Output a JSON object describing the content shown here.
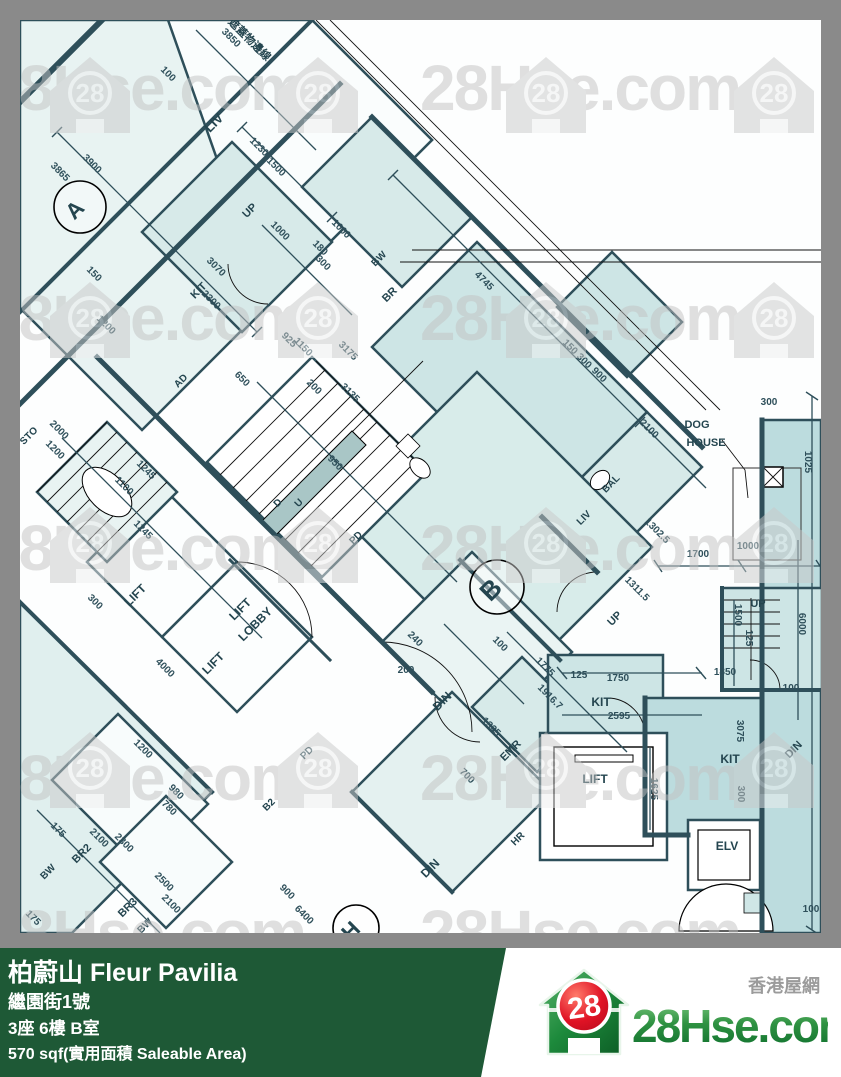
{
  "watermark": {
    "text": "28Hse.com",
    "badge": "28"
  },
  "footer": {
    "title": "柏蔚山 Fleur Pavilia",
    "address": "繼園街1號",
    "unit": "3座 6樓 B室",
    "area": "570 sqf(實用面積 Saleable Area)"
  },
  "logo": {
    "badge": "28",
    "site": "28Hse.com",
    "tagline": "香港屋網"
  },
  "plan": {
    "boundary_note": "遮蓋物邊線",
    "unit_markers": [
      {
        "t": "A",
        "x": 80,
        "y": 215,
        "r": -45,
        "s": 22
      },
      {
        "t": "B",
        "x": 497,
        "y": 596,
        "r": -45,
        "s": 26
      },
      {
        "t": "H",
        "x": 356,
        "y": 936,
        "r": -45,
        "s": 22
      }
    ],
    "room_labels": [
      {
        "t": "LIV",
        "x": 217,
        "y": 126,
        "r": -45,
        "s": 13
      },
      {
        "t": "UP",
        "x": 252,
        "y": 213,
        "r": -45,
        "s": 11
      },
      {
        "t": "BW",
        "x": 381,
        "y": 261,
        "r": -45,
        "s": 10
      },
      {
        "t": "BR",
        "x": 392,
        "y": 297,
        "r": -45,
        "s": 11
      },
      {
        "t": "KIT",
        "x": 201,
        "y": 293,
        "r": -45,
        "s": 11
      },
      {
        "t": "AD",
        "x": 183,
        "y": 383,
        "r": -45,
        "s": 10
      },
      {
        "t": "STO",
        "x": 31,
        "y": 438,
        "r": -45,
        "s": 10
      },
      {
        "t": "BAL",
        "x": 613,
        "y": 486,
        "r": -45,
        "s": 10
      },
      {
        "t": "LIV",
        "x": 586,
        "y": 520,
        "r": -45,
        "s": 10
      },
      {
        "t": "LIFT",
        "x": 138,
        "y": 598,
        "r": -45,
        "s": 12
      },
      {
        "t": "LIFT",
        "x": 243,
        "y": 612,
        "r": -45,
        "s": 12
      },
      {
        "t": "LOBBY",
        "x": 258,
        "y": 627,
        "r": -45,
        "s": 12
      },
      {
        "t": "LIFT",
        "x": 216,
        "y": 666,
        "r": -45,
        "s": 12
      },
      {
        "t": "DIN",
        "x": 445,
        "y": 704,
        "r": -45,
        "s": 12
      },
      {
        "t": "DIN",
        "x": 433,
        "y": 871,
        "r": -45,
        "s": 12
      },
      {
        "t": "DIN",
        "x": 796,
        "y": 752,
        "r": -45,
        "s": 11
      },
      {
        "t": "EMR",
        "x": 513,
        "y": 753,
        "r": -45,
        "s": 11
      },
      {
        "t": "HR",
        "x": 520,
        "y": 841,
        "r": -45,
        "s": 10
      },
      {
        "t": "KIT",
        "x": 601,
        "y": 706,
        "r": 0,
        "s": 12
      },
      {
        "t": "KIT",
        "x": 730,
        "y": 763,
        "r": 0,
        "s": 12
      },
      {
        "t": "UP",
        "x": 617,
        "y": 621,
        "r": -45,
        "s": 11
      },
      {
        "t": "UP",
        "x": 758,
        "y": 607,
        "r": 0,
        "s": 11
      },
      {
        "t": "LIFT",
        "x": 595,
        "y": 783,
        "r": 0,
        "s": 12
      },
      {
        "t": "ELV",
        "x": 727,
        "y": 850,
        "r": 0,
        "s": 12
      },
      {
        "t": "BW",
        "x": 50,
        "y": 874,
        "r": -45,
        "s": 10
      },
      {
        "t": "BR2",
        "x": 84,
        "y": 856,
        "r": -45,
        "s": 11
      },
      {
        "t": "BR3",
        "x": 130,
        "y": 910,
        "r": -45,
        "s": 11
      },
      {
        "t": "BW",
        "x": 147,
        "y": 928,
        "r": -45,
        "s": 10
      },
      {
        "t": "B2",
        "x": 271,
        "y": 807,
        "r": -45,
        "s": 10
      },
      {
        "t": "PD",
        "x": 309,
        "y": 755,
        "r": -45,
        "s": 10
      },
      {
        "t": "PD",
        "x": 358,
        "y": 540,
        "r": -45,
        "s": 10
      },
      {
        "t": "D",
        "x": 280,
        "y": 505,
        "r": -45,
        "s": 10
      },
      {
        "t": "U",
        "x": 301,
        "y": 505,
        "r": -45,
        "s": 10
      },
      {
        "t": "DOG",
        "x": 697,
        "y": 428,
        "r": 0,
        "s": 11
      },
      {
        "t": "HOUSE",
        "x": 706,
        "y": 446,
        "r": 0,
        "s": 11
      },
      {
        "t": "遮蓋物邊線",
        "x": 247,
        "y": 42,
        "r": 45,
        "s": 11
      }
    ],
    "dim_labels": [
      {
        "t": "3850",
        "x": 229,
        "y": 40,
        "r": 45
      },
      {
        "t": "100",
        "x": 166,
        "y": 76,
        "r": 45
      },
      {
        "t": "4745",
        "x": 482,
        "y": 283,
        "r": 45
      },
      {
        "t": "150",
        "x": 568,
        "y": 349,
        "r": 45
      },
      {
        "t": "300",
        "x": 582,
        "y": 363,
        "r": 45
      },
      {
        "t": "900",
        "x": 597,
        "y": 377,
        "r": 45
      },
      {
        "t": "2100",
        "x": 647,
        "y": 431,
        "r": 45
      },
      {
        "t": "1302.5",
        "x": 655,
        "y": 533,
        "r": 45
      },
      {
        "t": "1311.5",
        "x": 635,
        "y": 591,
        "r": 45
      },
      {
        "t": "1700",
        "x": 698,
        "y": 557,
        "r": 0
      },
      {
        "t": "1000",
        "x": 748,
        "y": 549,
        "r": 0
      },
      {
        "t": "300",
        "x": 769,
        "y": 405,
        "r": 0
      },
      {
        "t": "1025",
        "x": 805,
        "y": 462,
        "r": 90
      },
      {
        "t": "3900",
        "x": 90,
        "y": 166,
        "r": 45
      },
      {
        "t": "3865",
        "x": 58,
        "y": 174,
        "r": 45
      },
      {
        "t": "1230",
        "x": 257,
        "y": 149,
        "r": 45
      },
      {
        "t": "1500",
        "x": 274,
        "y": 169,
        "r": 45
      },
      {
        "t": "1000",
        "x": 278,
        "y": 233,
        "r": 45
      },
      {
        "t": "180",
        "x": 318,
        "y": 250,
        "r": 45
      },
      {
        "t": "1000",
        "x": 339,
        "y": 231,
        "r": 45
      },
      {
        "t": "300",
        "x": 321,
        "y": 265,
        "r": 45
      },
      {
        "t": "3070",
        "x": 214,
        "y": 269,
        "r": 45
      },
      {
        "t": "2300",
        "x": 209,
        "y": 302,
        "r": 45
      },
      {
        "t": "150",
        "x": 92,
        "y": 276,
        "r": 45
      },
      {
        "t": "1200",
        "x": 104,
        "y": 327,
        "r": 45
      },
      {
        "t": "650",
        "x": 240,
        "y": 381,
        "r": 45
      },
      {
        "t": "200",
        "x": 312,
        "y": 389,
        "r": 45
      },
      {
        "t": "925",
        "x": 287,
        "y": 342,
        "r": 45
      },
      {
        "t": "1150",
        "x": 301,
        "y": 349,
        "r": 45
      },
      {
        "t": "3175",
        "x": 346,
        "y": 353,
        "r": 45
      },
      {
        "t": "3135",
        "x": 348,
        "y": 395,
        "r": 45
      },
      {
        "t": "950",
        "x": 333,
        "y": 465,
        "r": 45
      },
      {
        "t": "2000",
        "x": 57,
        "y": 432,
        "r": 45
      },
      {
        "t": "1200",
        "x": 53,
        "y": 452,
        "r": 45
      },
      {
        "t": "1100",
        "x": 122,
        "y": 488,
        "r": 45
      },
      {
        "t": "1245",
        "x": 144,
        "y": 472,
        "r": 45
      },
      {
        "t": "1245",
        "x": 141,
        "y": 532,
        "r": 45
      },
      {
        "t": "300",
        "x": 93,
        "y": 604,
        "r": 45
      },
      {
        "t": "4000",
        "x": 163,
        "y": 670,
        "r": 45
      },
      {
        "t": "175",
        "x": 56,
        "y": 832,
        "r": 45
      },
      {
        "t": "2100",
        "x": 97,
        "y": 840,
        "r": 45
      },
      {
        "t": "2300",
        "x": 122,
        "y": 845,
        "r": 45
      },
      {
        "t": "1200",
        "x": 141,
        "y": 751,
        "r": 45
      },
      {
        "t": "780",
        "x": 167,
        "y": 810,
        "r": 45
      },
      {
        "t": "980",
        "x": 174,
        "y": 794,
        "r": 45
      },
      {
        "t": "2500",
        "x": 162,
        "y": 884,
        "r": 45
      },
      {
        "t": "2100",
        "x": 169,
        "y": 906,
        "r": 45
      },
      {
        "t": "900",
        "x": 285,
        "y": 894,
        "r": 45
      },
      {
        "t": "6400",
        "x": 302,
        "y": 917,
        "r": 45
      },
      {
        "t": "175",
        "x": 31,
        "y": 920,
        "r": 45
      },
      {
        "t": "1775",
        "x": 543,
        "y": 669,
        "r": 45
      },
      {
        "t": "1916.7",
        "x": 548,
        "y": 699,
        "r": 45
      },
      {
        "t": "1325",
        "x": 489,
        "y": 729,
        "r": 45
      },
      {
        "t": "700",
        "x": 465,
        "y": 778,
        "r": 45
      },
      {
        "t": "240",
        "x": 413,
        "y": 641,
        "r": 45
      },
      {
        "t": "100",
        "x": 498,
        "y": 646,
        "r": 45
      },
      {
        "t": "200",
        "x": 406,
        "y": 673,
        "r": 0
      },
      {
        "t": "125",
        "x": 579,
        "y": 678,
        "r": 0
      },
      {
        "t": "1750",
        "x": 618,
        "y": 681,
        "r": 0
      },
      {
        "t": "2595",
        "x": 619,
        "y": 719,
        "r": 0
      },
      {
        "t": "1625",
        "x": 651,
        "y": 789,
        "r": 90
      },
      {
        "t": "1500",
        "x": 735,
        "y": 615,
        "r": 90
      },
      {
        "t": "125",
        "x": 746,
        "y": 638,
        "r": 90
      },
      {
        "t": "6000",
        "x": 799,
        "y": 624,
        "r": 90
      },
      {
        "t": "1850",
        "x": 725,
        "y": 675,
        "r": 0
      },
      {
        "t": "100",
        "x": 791,
        "y": 691,
        "r": 0
      },
      {
        "t": "3075",
        "x": 737,
        "y": 731,
        "r": 90
      },
      {
        "t": "300",
        "x": 738,
        "y": 794,
        "r": 90
      },
      {
        "t": "100",
        "x": 811,
        "y": 912,
        "r": 0
      }
    ]
  }
}
